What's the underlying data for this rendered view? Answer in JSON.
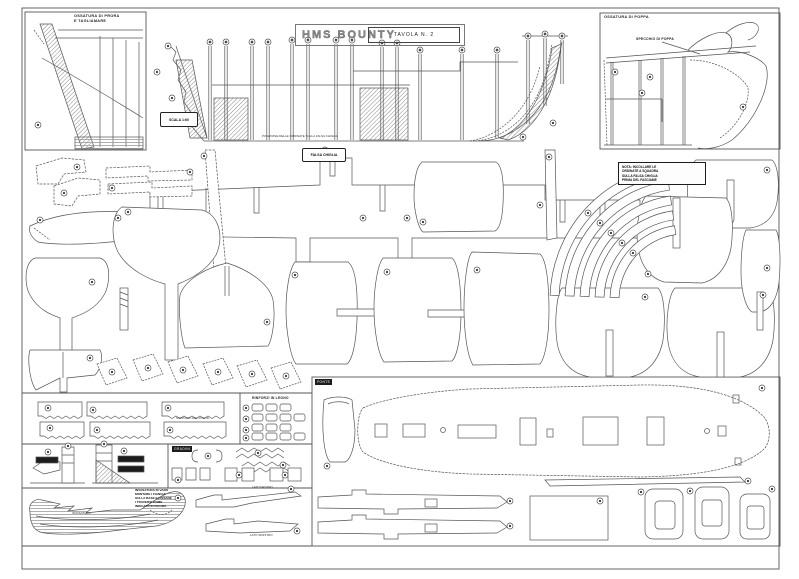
{
  "sheet": {
    "title": "HMS BOUNTY",
    "plate": "TAVOLA N. 2"
  },
  "bow_panel": {
    "line1": "OSSATURA DI PRORA",
    "line2": "E TAGLIAMARE"
  },
  "stern_panel": {
    "title": "OSSATURA DI POPPA",
    "inner_label": "SPECCHIO DI POPPA"
  },
  "hull": {
    "scale_label": "SCALA 1:60",
    "baseline_note": "POSIZIONE DELLE ORDINATE SULLA FALSA CHIGLIA"
  },
  "keel": {
    "label": "FALSA CHIGLIA"
  },
  "note_box": {
    "lines": [
      "NOTA: INCOLLARE LE",
      "ORDINATE A SQUADRA",
      "SULLA FALSA CHIGLIA",
      "PRIMA DEL FASCIAME"
    ]
  },
  "deck_panel": {
    "label": "PONTE"
  },
  "fittings_panel": {
    "heading": "RINFORZI IN LEGNO"
  },
  "strips_panel": {
    "label": "SUPPORTI DEL PONTE"
  },
  "small_parts_panel": {
    "label": "GRADINI"
  },
  "cradle_panel": {
    "note_lines": [
      "INVASATURA DI VARO",
      "MONTARE I FIANCHI",
      "SULLA BASE E FISSARE",
      "I TRAVERSI COME",
      "INDICATO IN FIGURA"
    ],
    "caption": "INVASATURA"
  },
  "wales": {
    "label_top": "LATO DESTRO",
    "label_bottom": "LATO SINISTRO"
  }
}
